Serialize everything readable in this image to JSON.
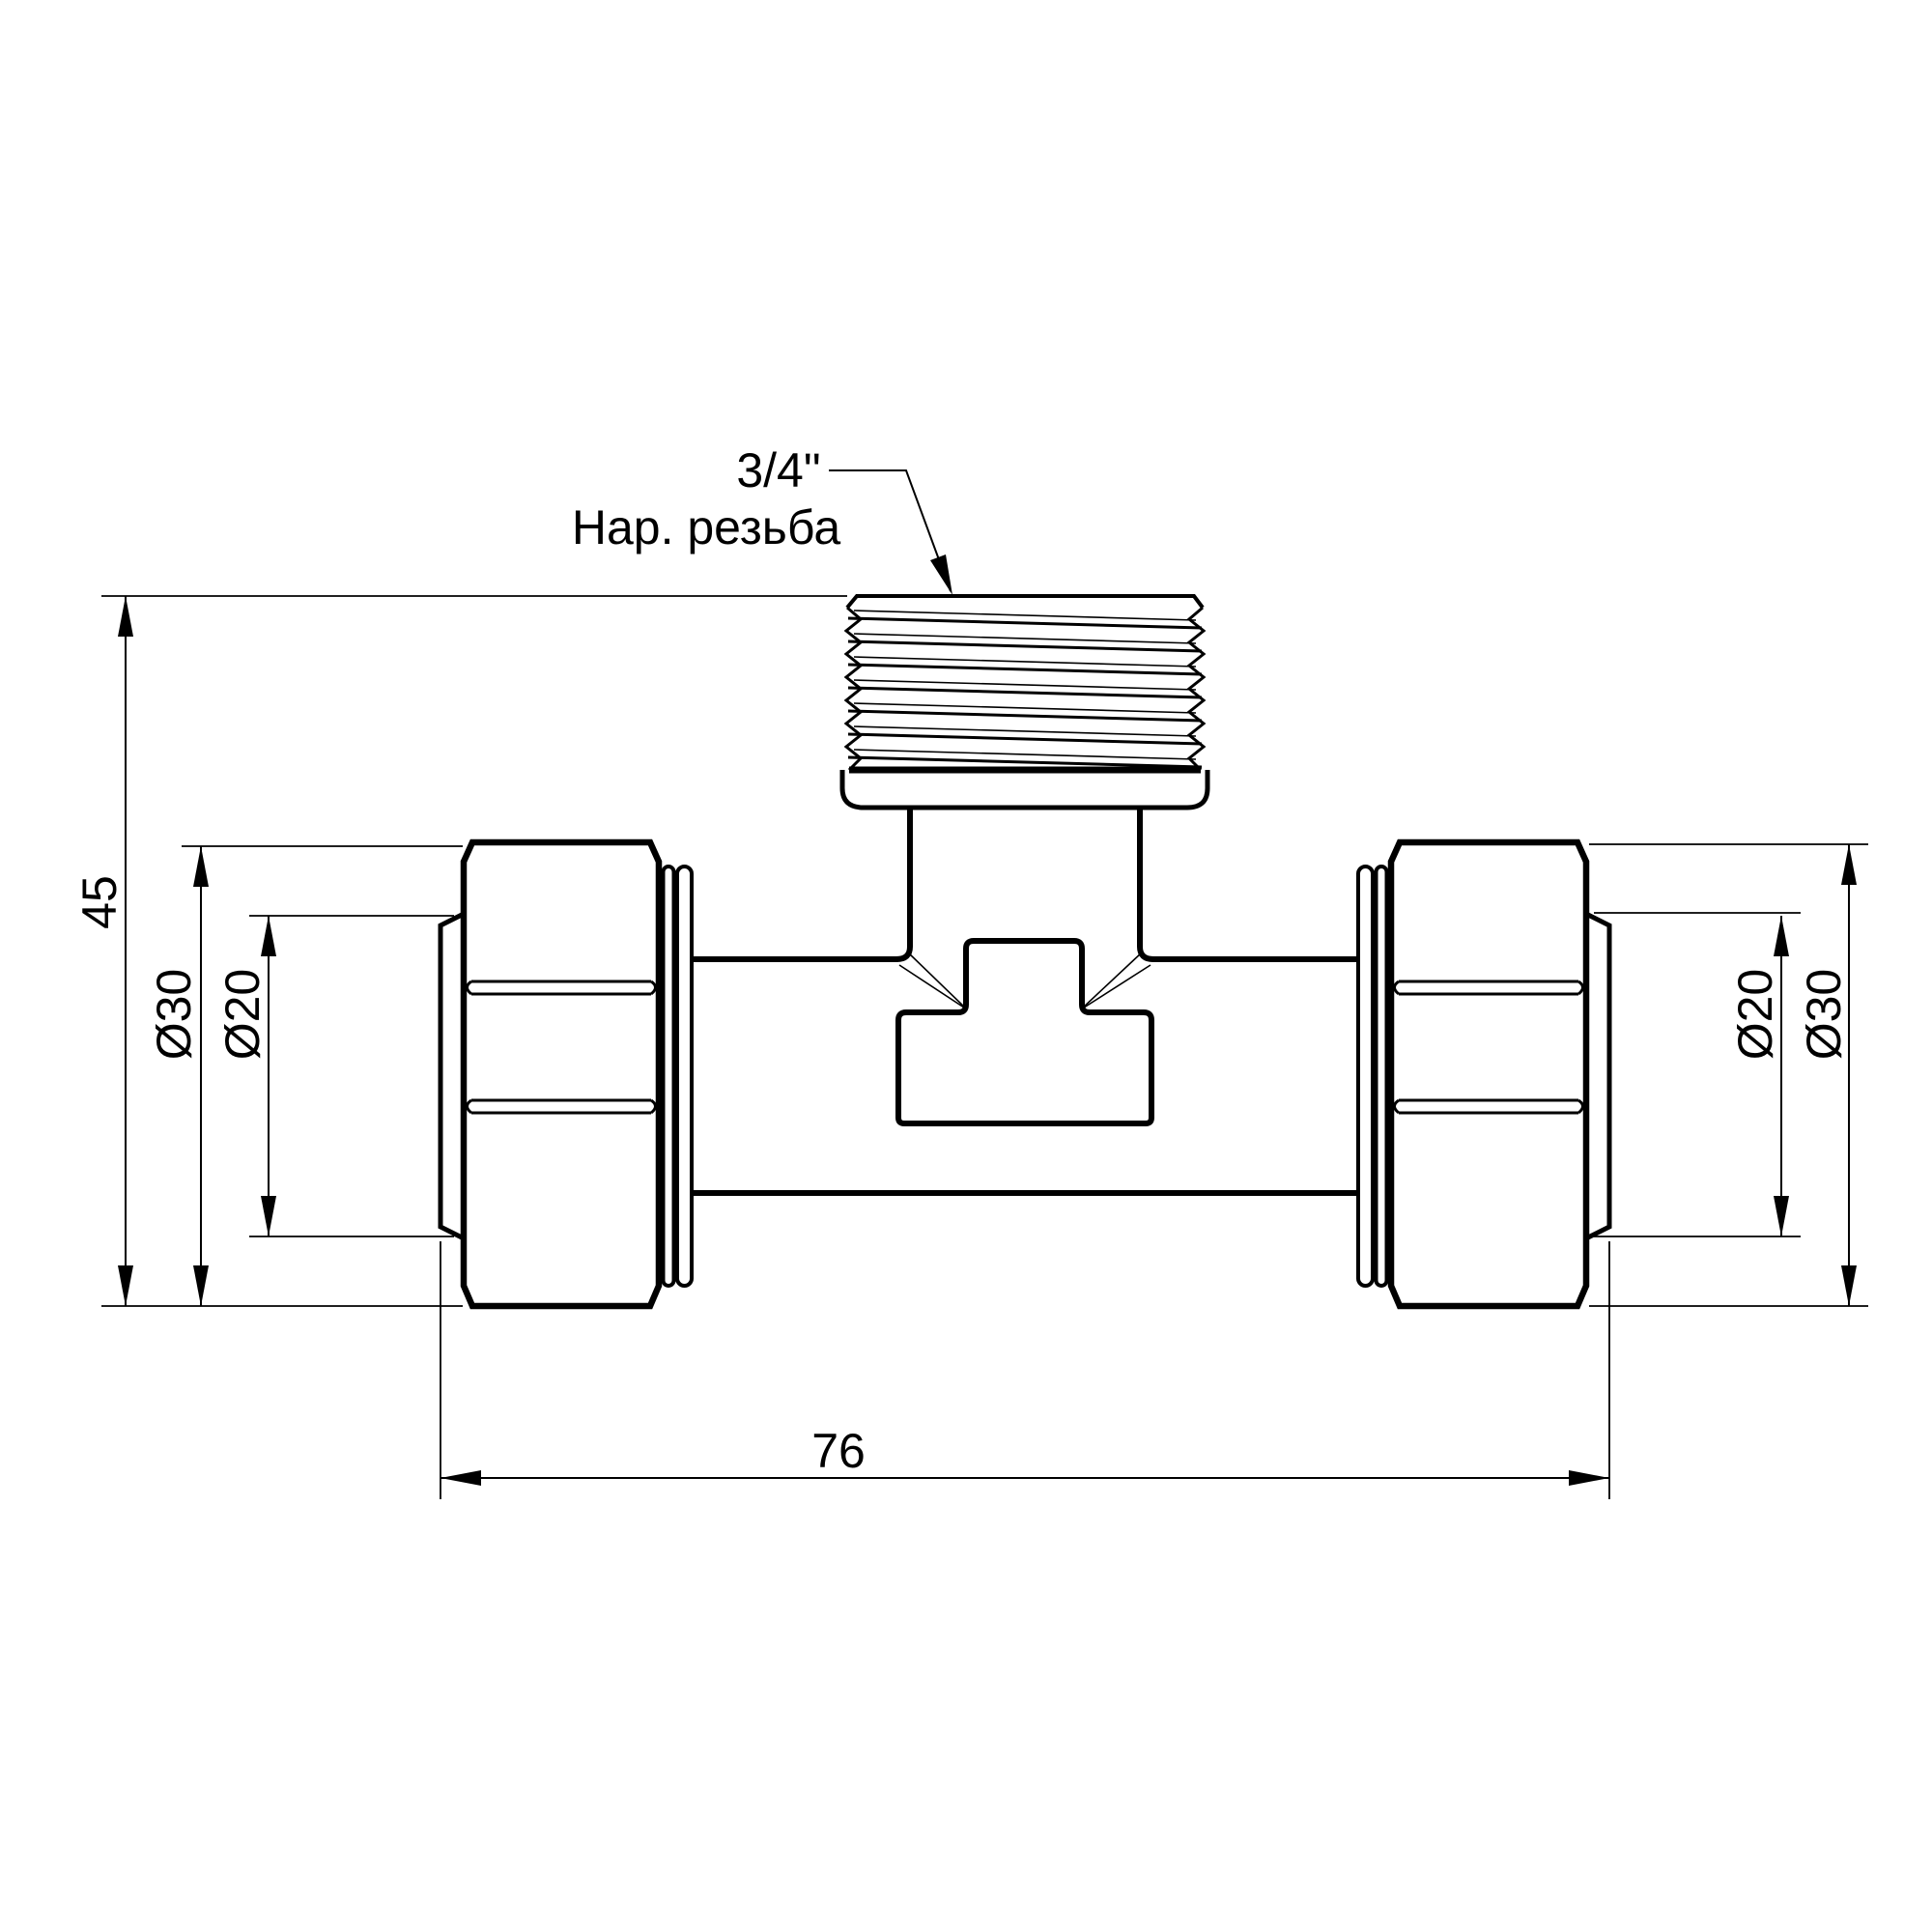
{
  "page": {
    "background": "#ffffff",
    "ink": "#000000",
    "kind": "technical drawing of tee compression fitting"
  },
  "callout": {
    "line1": "3/4\"",
    "line2": "Нар. резьба"
  },
  "dims": {
    "overall_height": "45",
    "left_nut_diameter": "Ø30",
    "left_pipe_diameter": "Ø20",
    "right_pipe_diameter": "Ø20",
    "right_nut_diameter": "Ø30",
    "overall_length": "76"
  }
}
